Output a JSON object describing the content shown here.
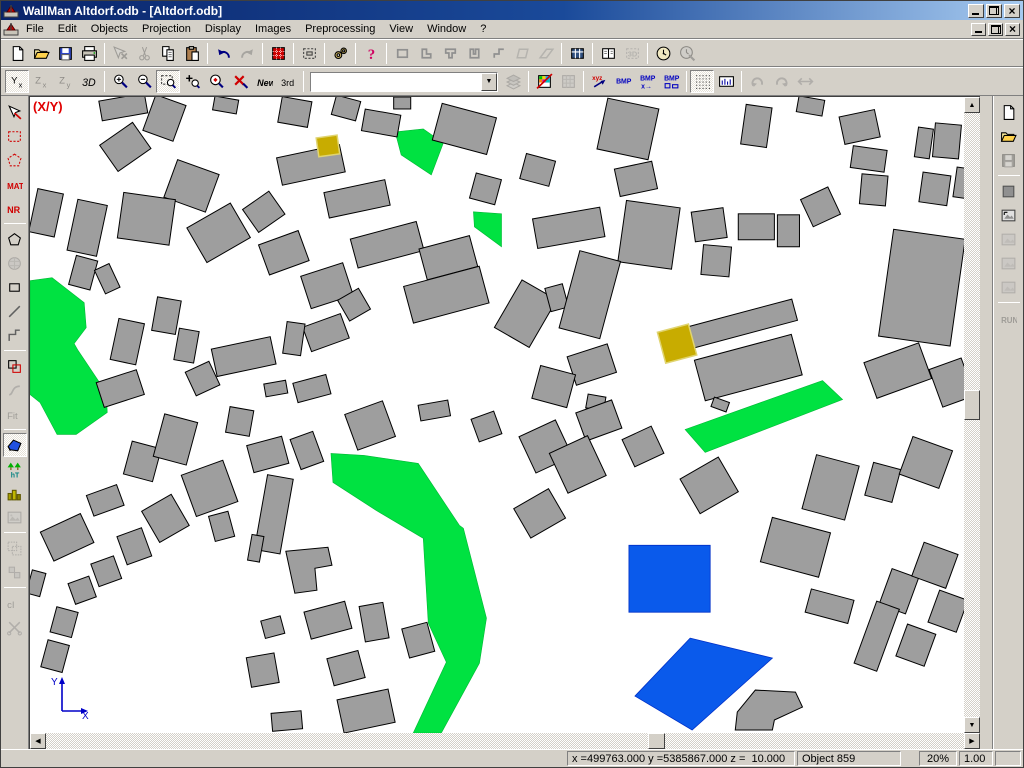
{
  "window": {
    "title": "WallMan Altdorf.odb - [Altdorf.odb]",
    "controls": [
      "minimize",
      "restore",
      "close"
    ]
  },
  "menu": {
    "items": [
      "File",
      "Edit",
      "Objects",
      "Projection",
      "Display",
      "Images",
      "Preprocessing",
      "View",
      "Window",
      "?"
    ]
  },
  "toolbar1": {
    "items": [
      {
        "n": "new"
      },
      {
        "n": "open"
      },
      {
        "n": "save"
      },
      {
        "n": "print"
      },
      {
        "n": "select-cross",
        "d": 1,
        "s": 1
      },
      {
        "n": "cut",
        "d": 1
      },
      {
        "n": "copy"
      },
      {
        "n": "paste"
      },
      {
        "n": "undo",
        "s": 1
      },
      {
        "n": "redo",
        "d": 1
      },
      {
        "n": "material-database",
        "s": 1
      },
      {
        "n": "object-properties",
        "s": 1
      },
      {
        "n": "settings",
        "s": 1
      },
      {
        "n": "help",
        "s": 1
      },
      {
        "n": "shape-rectangle",
        "s": 1
      },
      {
        "n": "shape-l"
      },
      {
        "n": "shape-t"
      },
      {
        "n": "shape-u"
      },
      {
        "n": "shape-s"
      },
      {
        "n": "shape-rhombus",
        "d": 1
      },
      {
        "n": "shape-ramp",
        "d": 1
      },
      {
        "n": "table",
        "s": 1
      },
      {
        "n": "split-view",
        "s": 1
      },
      {
        "n": "view-3d",
        "d": 1
      },
      {
        "n": "clock",
        "s": 1
      },
      {
        "n": "clock-edit",
        "d": 1
      }
    ]
  },
  "toolbar2": {
    "combo_value": "",
    "items": [
      {
        "n": "view-yx",
        "l": "Yx",
        "c": 1
      },
      {
        "n": "view-zx",
        "l": "Zx",
        "d": 1
      },
      {
        "n": "view-zy",
        "l": "Zy",
        "d": 1
      },
      {
        "n": "view-3d-mode",
        "l": "3D"
      },
      {
        "n": "zoom-in",
        "s": 1
      },
      {
        "n": "zoom-out"
      },
      {
        "n": "zoom-window",
        "c": 1
      },
      {
        "n": "zoom-pan"
      },
      {
        "n": "zoom-selected"
      },
      {
        "n": "zoom-reset"
      },
      {
        "n": "new-object",
        "l": "New"
      },
      {
        "n": "third",
        "l": "3rd"
      },
      {
        "n": "object-combo",
        "combo": 1,
        "s": 1
      },
      {
        "n": "layers",
        "d": 1
      },
      {
        "n": "pixel-map",
        "s": 1
      },
      {
        "n": "pixel-map-gray",
        "d": 1
      },
      {
        "n": "xyz-export",
        "s": 1
      },
      {
        "n": "bmp",
        "l": "BMP"
      },
      {
        "n": "bmp-export",
        "l": "BMP"
      },
      {
        "n": "bmp-size",
        "l": "BMP"
      },
      {
        "n": "grid",
        "c": 1,
        "s": 1
      },
      {
        "n": "ruler"
      },
      {
        "n": "rotate-left",
        "d": 1,
        "s": 1
      },
      {
        "n": "rotate-right",
        "d": 1
      },
      {
        "n": "flip",
        "d": 1
      }
    ]
  },
  "left_toolbar": {
    "items": [
      {
        "n": "select-arrow"
      },
      {
        "n": "select-rect"
      },
      {
        "n": "select-polygon"
      },
      {
        "n": "material",
        "l": "MAT"
      },
      {
        "n": "number",
        "l": "NR"
      },
      {
        "n": "draw-polygon",
        "s": 1
      },
      {
        "n": "draw-cylinder",
        "d": 1
      },
      {
        "n": "draw-rectangle"
      },
      {
        "n": "draw-line"
      },
      {
        "n": "draw-polyline"
      },
      {
        "n": "combine-objects",
        "s": 1
      },
      {
        "n": "curve",
        "d": 1
      },
      {
        "n": "fit",
        "l": "Fit",
        "d": 1
      },
      {
        "n": "vegetation",
        "c": 1,
        "s": 1
      },
      {
        "n": "trees"
      },
      {
        "n": "buildings"
      },
      {
        "n": "image",
        "d": 1
      },
      {
        "n": "group",
        "d": 1,
        "s": 1
      },
      {
        "n": "ungroup",
        "d": 1
      },
      {
        "n": "convert-ci",
        "l": "cI",
        "d": 1,
        "s": 1
      },
      {
        "n": "cut-object",
        "d": 1
      }
    ]
  },
  "right_toolbar": {
    "items": [
      {
        "n": "new-database"
      },
      {
        "n": "open-database"
      },
      {
        "n": "save-database",
        "d": 1
      },
      {
        "n": "material-square",
        "s": 1
      },
      {
        "n": "image-size"
      },
      {
        "n": "image-2",
        "d": 1
      },
      {
        "n": "image-3",
        "d": 1
      },
      {
        "n": "image-4",
        "d": 1
      },
      {
        "n": "run",
        "l": "RUN",
        "d": 1,
        "s": 1
      }
    ]
  },
  "map": {
    "overlay_label": "(X/Y)",
    "axis_labels": {
      "x": "X",
      "y": "Y"
    },
    "colors": {
      "background": "#ffffff",
      "building": "#9e9e9e",
      "building_outline": "#000000",
      "vegetation": "#00e241",
      "water": "#0a5aeb",
      "water_outline": "#0030c8",
      "selected": "#c8ac00",
      "selected_outline": "#e0d470"
    },
    "buildings_rects": [
      [
        93,
        10,
        46,
        20,
        -10
      ],
      [
        134,
        21,
        32,
        38,
        20
      ],
      [
        95,
        50,
        40,
        32,
        -35
      ],
      [
        195,
        8,
        24,
        14,
        10
      ],
      [
        264,
        15,
        30,
        26,
        10
      ],
      [
        315,
        11,
        25,
        20,
        15
      ],
      [
        350,
        26,
        36,
        22,
        10
      ],
      [
        371,
        6,
        17,
        12,
        0
      ],
      [
        433,
        32,
        56,
        38,
        15
      ],
      [
        280,
        68,
        64,
        28,
        -12
      ],
      [
        161,
        89,
        44,
        40,
        20
      ],
      [
        116,
        122,
        52,
        46,
        8
      ],
      [
        188,
        136,
        50,
        40,
        -30
      ],
      [
        16,
        116,
        26,
        44,
        12
      ],
      [
        57,
        131,
        30,
        52,
        12
      ],
      [
        233,
        115,
        32,
        28,
        -35
      ],
      [
        326,
        102,
        62,
        26,
        -12
      ],
      [
        454,
        92,
        26,
        26,
        15
      ],
      [
        356,
        148,
        68,
        30,
        -15
      ],
      [
        417,
        161,
        52,
        32,
        -15
      ],
      [
        253,
        156,
        42,
        32,
        -20
      ],
      [
        53,
        176,
        22,
        30,
        15
      ],
      [
        77,
        182,
        16,
        26,
        -25
      ],
      [
        296,
        189,
        44,
        34,
        -18
      ],
      [
        415,
        198,
        78,
        38,
        -15
      ],
      [
        136,
        219,
        24,
        34,
        10
      ],
      [
        97,
        245,
        26,
        42,
        12
      ],
      [
        323,
        208,
        24,
        24,
        -30
      ],
      [
        295,
        236,
        40,
        26,
        -20
      ],
      [
        263,
        242,
        18,
        32,
        8
      ],
      [
        213,
        260,
        60,
        28,
        -12
      ],
      [
        156,
        249,
        20,
        32,
        10
      ],
      [
        172,
        282,
        26,
        26,
        -25
      ],
      [
        90,
        292,
        42,
        26,
        -18
      ],
      [
        245,
        292,
        22,
        13,
        -10
      ],
      [
        281,
        292,
        34,
        20,
        -15
      ],
      [
        596,
        32,
        52,
        52,
        12
      ],
      [
        506,
        73,
        30,
        26,
        15
      ],
      [
        604,
        82,
        38,
        28,
        -12
      ],
      [
        724,
        29,
        26,
        40,
        8
      ],
      [
        778,
        9,
        26,
        16,
        10
      ],
      [
        827,
        30,
        36,
        28,
        -12
      ],
      [
        836,
        62,
        34,
        22,
        8
      ],
      [
        841,
        93,
        26,
        30,
        5
      ],
      [
        891,
        46,
        15,
        30,
        8
      ],
      [
        914,
        44,
        26,
        34,
        5
      ],
      [
        902,
        92,
        28,
        30,
        8
      ],
      [
        929,
        86,
        14,
        30,
        8
      ],
      [
        537,
        131,
        68,
        30,
        -10
      ],
      [
        617,
        138,
        54,
        62,
        8
      ],
      [
        677,
        128,
        32,
        30,
        -8
      ],
      [
        724,
        130,
        36,
        26,
        0
      ],
      [
        756,
        134,
        22,
        32,
        0
      ],
      [
        788,
        110,
        30,
        30,
        -25
      ],
      [
        684,
        164,
        28,
        30,
        5
      ],
      [
        889,
        191,
        72,
        108,
        8
      ],
      [
        494,
        217,
        40,
        55,
        30
      ],
      [
        525,
        201,
        18,
        24,
        -15
      ],
      [
        558,
        198,
        42,
        80,
        15
      ],
      [
        710,
        227,
        108,
        22,
        -15
      ],
      [
        716,
        271,
        100,
        42,
        -15
      ],
      [
        560,
        268,
        42,
        30,
        -18
      ],
      [
        522,
        290,
        36,
        34,
        15
      ],
      [
        564,
        306,
        18,
        14,
        10
      ],
      [
        865,
        274,
        58,
        38,
        -20
      ],
      [
        919,
        286,
        34,
        40,
        -20
      ],
      [
        112,
        365,
        30,
        34,
        15
      ],
      [
        145,
        343,
        34,
        44,
        15
      ],
      [
        209,
        325,
        24,
        26,
        10
      ],
      [
        237,
        358,
        36,
        28,
        -15
      ],
      [
        276,
        354,
        24,
        32,
        -20
      ],
      [
        339,
        329,
        40,
        38,
        -20
      ],
      [
        403,
        314,
        30,
        16,
        -10
      ],
      [
        455,
        330,
        24,
        24,
        -20
      ],
      [
        179,
        392,
        44,
        44,
        -20
      ],
      [
        75,
        404,
        32,
        22,
        -20
      ],
      [
        135,
        422,
        34,
        36,
        -30
      ],
      [
        37,
        441,
        44,
        32,
        -25
      ],
      [
        104,
        450,
        26,
        30,
        -20
      ],
      [
        191,
        430,
        20,
        26,
        -15
      ],
      [
        243,
        418,
        26,
        76,
        10
      ],
      [
        225,
        452,
        12,
        26,
        10
      ],
      [
        76,
        475,
        24,
        24,
        -20
      ],
      [
        52,
        494,
        22,
        22,
        -20
      ],
      [
        34,
        526,
        22,
        26,
        15
      ],
      [
        25,
        560,
        22,
        28,
        15
      ],
      [
        6,
        487,
        14,
        24,
        15
      ],
      [
        242,
        531,
        20,
        18,
        -15
      ],
      [
        297,
        524,
        42,
        28,
        -15
      ],
      [
        343,
        526,
        24,
        36,
        -10
      ],
      [
        387,
        544,
        26,
        30,
        -15
      ],
      [
        232,
        574,
        28,
        30,
        -10
      ],
      [
        315,
        572,
        32,
        28,
        -15
      ],
      [
        335,
        615,
        52,
        34,
        -12
      ],
      [
        256,
        625,
        30,
        18,
        -5
      ],
      [
        567,
        324,
        38,
        30,
        -20
      ],
      [
        514,
        350,
        40,
        40,
        -25
      ],
      [
        546,
        368,
        42,
        44,
        -25
      ],
      [
        611,
        350,
        32,
        30,
        -25
      ],
      [
        677,
        389,
        44,
        40,
        -30
      ],
      [
        508,
        417,
        40,
        34,
        -30
      ],
      [
        798,
        391,
        44,
        56,
        15
      ],
      [
        850,
        386,
        28,
        34,
        15
      ],
      [
        893,
        366,
        42,
        40,
        20
      ],
      [
        763,
        451,
        60,
        46,
        15
      ],
      [
        866,
        495,
        28,
        38,
        20
      ],
      [
        902,
        469,
        36,
        36,
        20
      ],
      [
        915,
        515,
        30,
        34,
        20
      ],
      [
        797,
        510,
        44,
        24,
        15
      ],
      [
        844,
        540,
        24,
        66,
        20
      ],
      [
        883,
        549,
        30,
        34,
        20
      ],
      [
        688,
        308,
        16,
        10,
        20
      ]
    ],
    "buildings_polys": [
      "705,616 723,594 763,596 770,611 742,624 740,634 703,634",
      "255,455 297,451 301,469 284,472 286,494 264,497"
    ],
    "vegetation_polys": [
      "0,184 22,181 54,206 56,231 44,247 48,254 76,296 77,316 46,338 27,338 10,306 0,298",
      "364,35 392,32 412,46 400,78 370,58",
      "442,115 470,117 470,150 443,130",
      "653,333 790,284 810,303 673,356",
      "300,357 333,359 387,367 428,429 432,432 455,522 448,567 410,637 382,637 415,566 397,527 392,442 345,414 302,386"
    ],
    "water_polys": [
      "597,449 678,449 678,516 597,516",
      "658,542 740,562 660,634 603,600"
    ],
    "selected_rects": [
      [
        297,
        49,
        21,
        19,
        -8
      ],
      [
        645,
        247,
        32,
        32,
        -15
      ]
    ]
  },
  "scrollbars": {
    "h_thumb_pos": "65%",
    "v_thumb_pos": "46%"
  },
  "status_bar": {
    "coords": "x =499763.000 y =5385867.000 z =  10.000",
    "object_info": "Object 859",
    "zoom_level": "20%",
    "scale_factor": "1.00"
  }
}
